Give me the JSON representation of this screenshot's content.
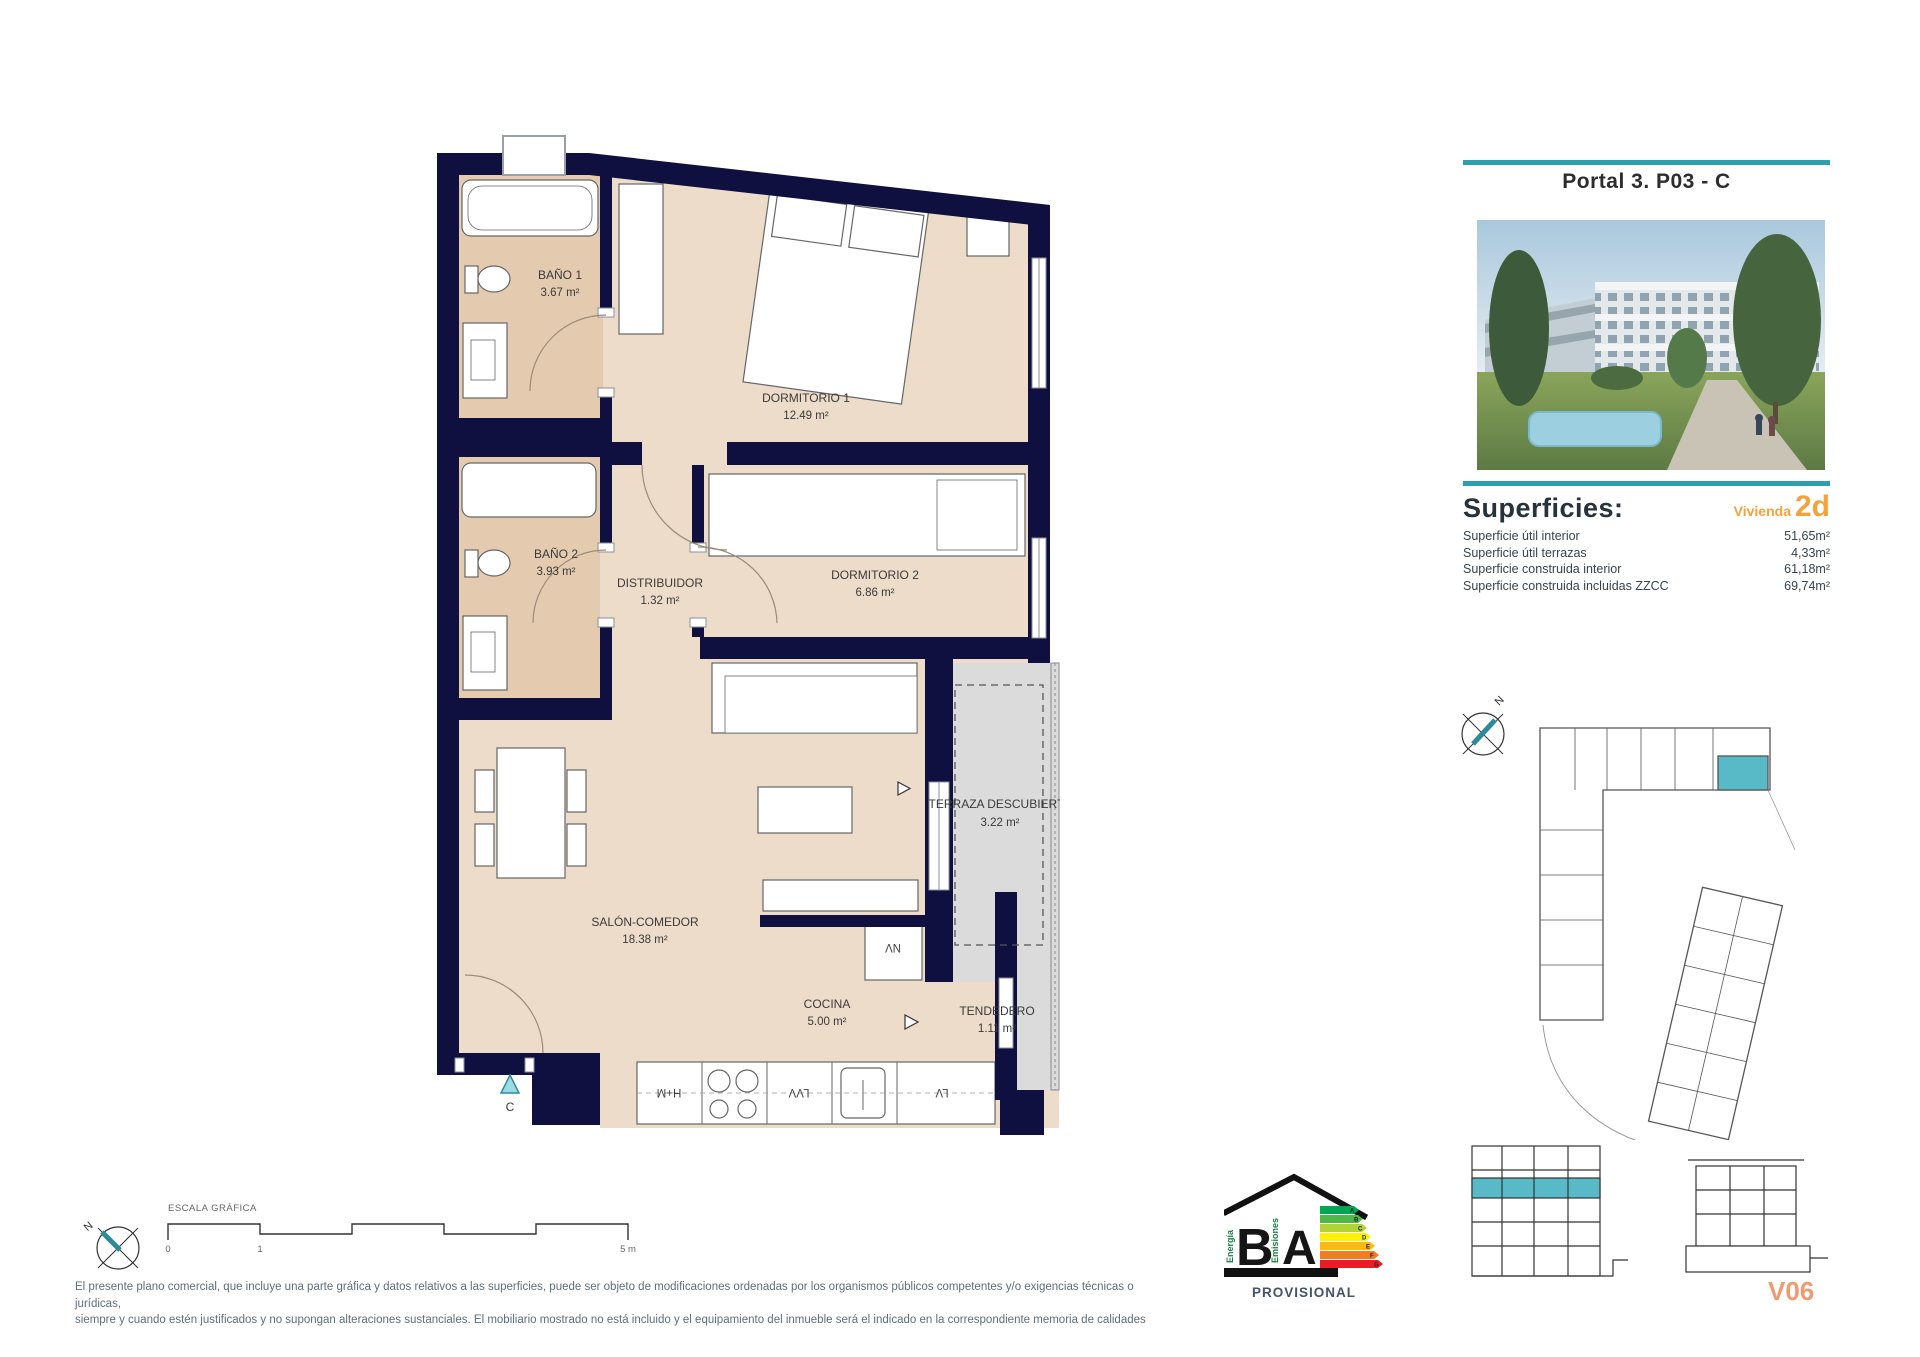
{
  "header": {
    "title": "Portal 3. P03 - C"
  },
  "superficies": {
    "heading": "Superficies:",
    "vivienda_label": "Vivienda",
    "vivienda_code": "2d",
    "rows": [
      {
        "label": "Superficie útil interior",
        "value": "51,65m²"
      },
      {
        "label": "Superficie útil terrazas",
        "value": "4,33m²"
      },
      {
        "label": "Superficie construida interior",
        "value": "61,18m²"
      },
      {
        "label": "Superficie construida incluidas ZZCC",
        "value": "69,74m²"
      }
    ]
  },
  "plan": {
    "rooms": {
      "bano1": {
        "name": "BAÑO 1",
        "area": "3.67 m²"
      },
      "bano2": {
        "name": "BAÑO 2",
        "area": "3.93 m²"
      },
      "dormitorio1": {
        "name": "DORMITORIO 1",
        "area": "12.49 m²"
      },
      "dormitorio2": {
        "name": "DORMITORIO 2",
        "area": "6.86 m²"
      },
      "distribuidor": {
        "name": "DISTRIBUIDOR",
        "area": "1.32 m²"
      },
      "salon": {
        "name": "SALÓN-COMEDOR",
        "area": "18.38 m²"
      },
      "cocina": {
        "name": "COCINA",
        "area": "5.00 m²"
      },
      "terraza": {
        "name": "TERRAZA DESCUBIERTA",
        "area": "3.22 m²"
      },
      "tendedero": {
        "name": "TENDEDERO",
        "area": "1.11 m²"
      }
    },
    "labels": {
      "nv": "NV",
      "hm": "H+M",
      "lvv": "LVV",
      "lv": "LV",
      "entrance": "C"
    }
  },
  "scalebar": {
    "title": "ESCALA GRÁFICA",
    "t0": "0",
    "t1": "1",
    "t5": "5 m"
  },
  "compass": {
    "n": "N"
  },
  "energy": {
    "energy_letter": "B",
    "emissions_letter": "A",
    "energy_word": "Energía",
    "emissions_word": "Emisiones",
    "status": "PROVISIONAL",
    "scale": [
      "A",
      "B",
      "C",
      "D",
      "E",
      "F",
      "G"
    ],
    "colors": [
      "#00a651",
      "#50b848",
      "#b2d235",
      "#fff200",
      "#fdb913",
      "#f47b20",
      "#ed1c24"
    ]
  },
  "footer": {
    "line1": "El presente plano comercial, que incluye una parte gráfica y datos relativos a las superficies, puede ser objeto de modificaciones ordenadas por los organismos públicos competentes y/o exigencias técnicas o jurídicas,",
    "line2": "siempre y cuando estén justificados y no supongan alteraciones sustanciales. El mobiliario mostrado no está incluido y el equipamiento del inmueble será el indicado en la correspondiente memoria de calidades"
  },
  "plan_code": "V06",
  "colors": {
    "wall": "#0f1040",
    "room": "#eddcca",
    "bath": "#e4cbb0",
    "terrace": "#dbdbdb",
    "teal": "#2e9fad",
    "unit_highlight": "#58bac6",
    "orange": "#f2a33c",
    "code": "#f09a72"
  }
}
